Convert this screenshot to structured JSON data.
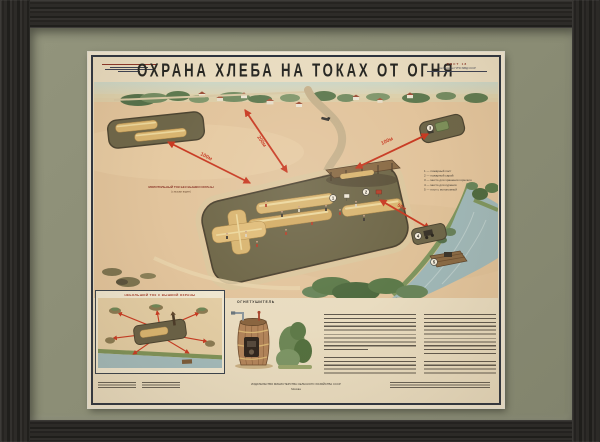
{
  "artwork": {
    "title": "ОХРАНА ХЛЕБА НА ТОКАХ ОТ ОГНЯ",
    "sheet_label": "ЛИСТ 18",
    "approval_label": "Согласовано ГУПО МВД СССР",
    "publisher": "ИЗДАТЕЛЬСТВО МИНИСТЕРСТВА СЕЛЬСКОГО ХОЗЯЙСТВА СССР",
    "publisher_city": "Москва"
  },
  "scene": {
    "distances": {
      "reserve": "100м",
      "village": "200м",
      "fuel": "100м",
      "river": "50м"
    },
    "reserve_caption": {
      "line1": "МОЛОТИЛЬНЫЙ ТОК БЕЗ ВЫШКИ ОХРАНЫ",
      "line2": "(с вышки виден)"
    },
    "markers": [
      "1",
      "2",
      "3",
      "4",
      "5"
    ],
    "legend": [
      "1 — пожарный пост",
      "2 — пожарный сарай",
      "3 — место для хранения горючего",
      "4 — место для курения",
      "5 — плот с мотопомпой"
    ]
  },
  "insets": {
    "plan_title": "НЕБОЛЬШОЙ ТОК С ВЫШКОЙ ОХРАНЫ",
    "extinguisher_title": "ОГНЕТУШИТЕЛЬ"
  },
  "colors": {
    "accent_red": "#c83a22",
    "mat": "#8a8c74",
    "frame": "#2c2b29",
    "paper": "#e9dcc0",
    "field": "#e2c49c",
    "floor": "#6e6649",
    "water": "#a0b8b8",
    "stack": "#d9b570"
  }
}
